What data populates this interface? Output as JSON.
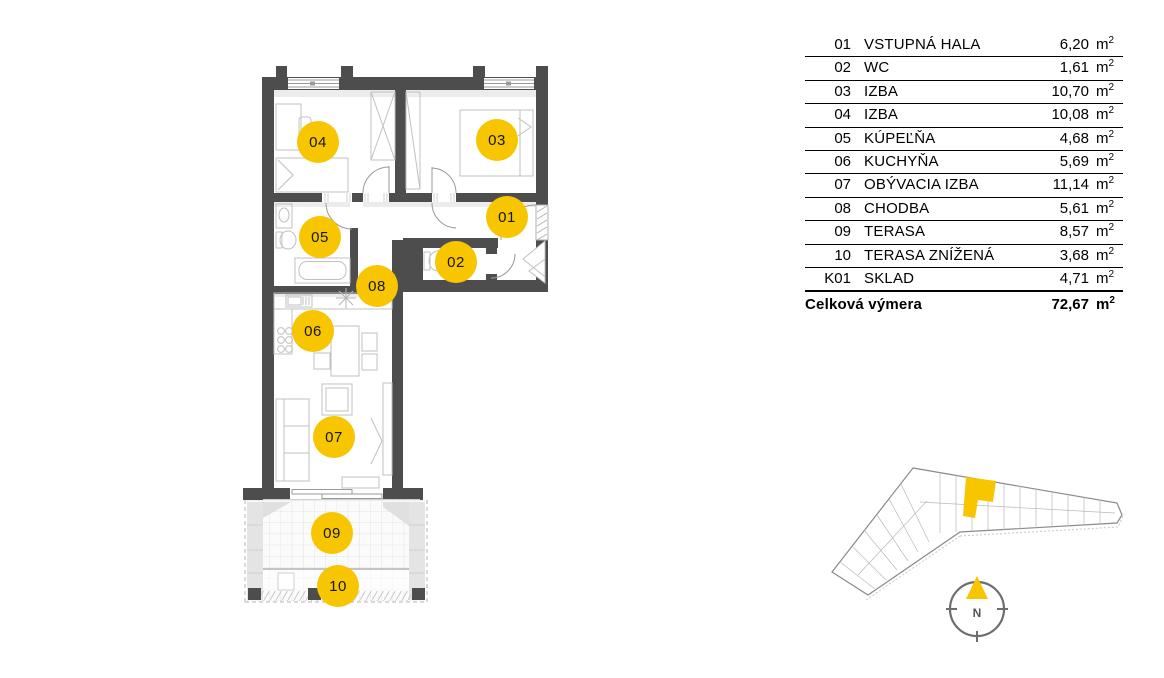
{
  "legend": {
    "rows": [
      {
        "num": "01",
        "name": "VSTUPNÁ HALA",
        "area": "6,20"
      },
      {
        "num": "02",
        "name": "WC",
        "area": "1,61"
      },
      {
        "num": "03",
        "name": "IZBA",
        "area": "10,70"
      },
      {
        "num": "04",
        "name": "IZBA",
        "area": "10,08"
      },
      {
        "num": "05",
        "name": "KÚPEĽŇA",
        "area": "4,68"
      },
      {
        "num": "06",
        "name": "KUCHYŇA",
        "area": "5,69"
      },
      {
        "num": "07",
        "name": "OBÝVACIA IZBA",
        "area": "11,14"
      },
      {
        "num": "08",
        "name": "CHODBA",
        "area": "5,61"
      },
      {
        "num": "09",
        "name": "TERASA",
        "area": "8,57"
      },
      {
        "num": "10",
        "name": "TERASA ZNÍŽENÁ",
        "area": "3,68"
      },
      {
        "num": "K01",
        "name": "SKLAD",
        "area": "4,71"
      }
    ],
    "total": {
      "label": "Celková výmera",
      "area": "72,67"
    },
    "unit_base": "m",
    "unit_exponent": "2"
  },
  "plan": {
    "bubble_color": "#F7C600",
    "bubbles": [
      {
        "label": "04",
        "x": 318,
        "y": 142
      },
      {
        "label": "03",
        "x": 497,
        "y": 140
      },
      {
        "label": "01",
        "x": 507,
        "y": 217
      },
      {
        "label": "05",
        "x": 320,
        "y": 237
      },
      {
        "label": "02",
        "x": 456,
        "y": 262
      },
      {
        "label": "08",
        "x": 377,
        "y": 286
      },
      {
        "label": "06",
        "x": 313,
        "y": 331
      },
      {
        "label": "07",
        "x": 334,
        "y": 437
      },
      {
        "label": "09",
        "x": 332,
        "y": 533
      },
      {
        "label": "10",
        "x": 338,
        "y": 586
      }
    ]
  },
  "overview": {
    "highlight_color": "#F7C600"
  },
  "compass": {
    "label": "N",
    "needle_color": "#F7C600"
  },
  "colors": {
    "wall": "#4d4d4d",
    "furniture": "#c0c0c0",
    "accent": "#F7C600"
  }
}
